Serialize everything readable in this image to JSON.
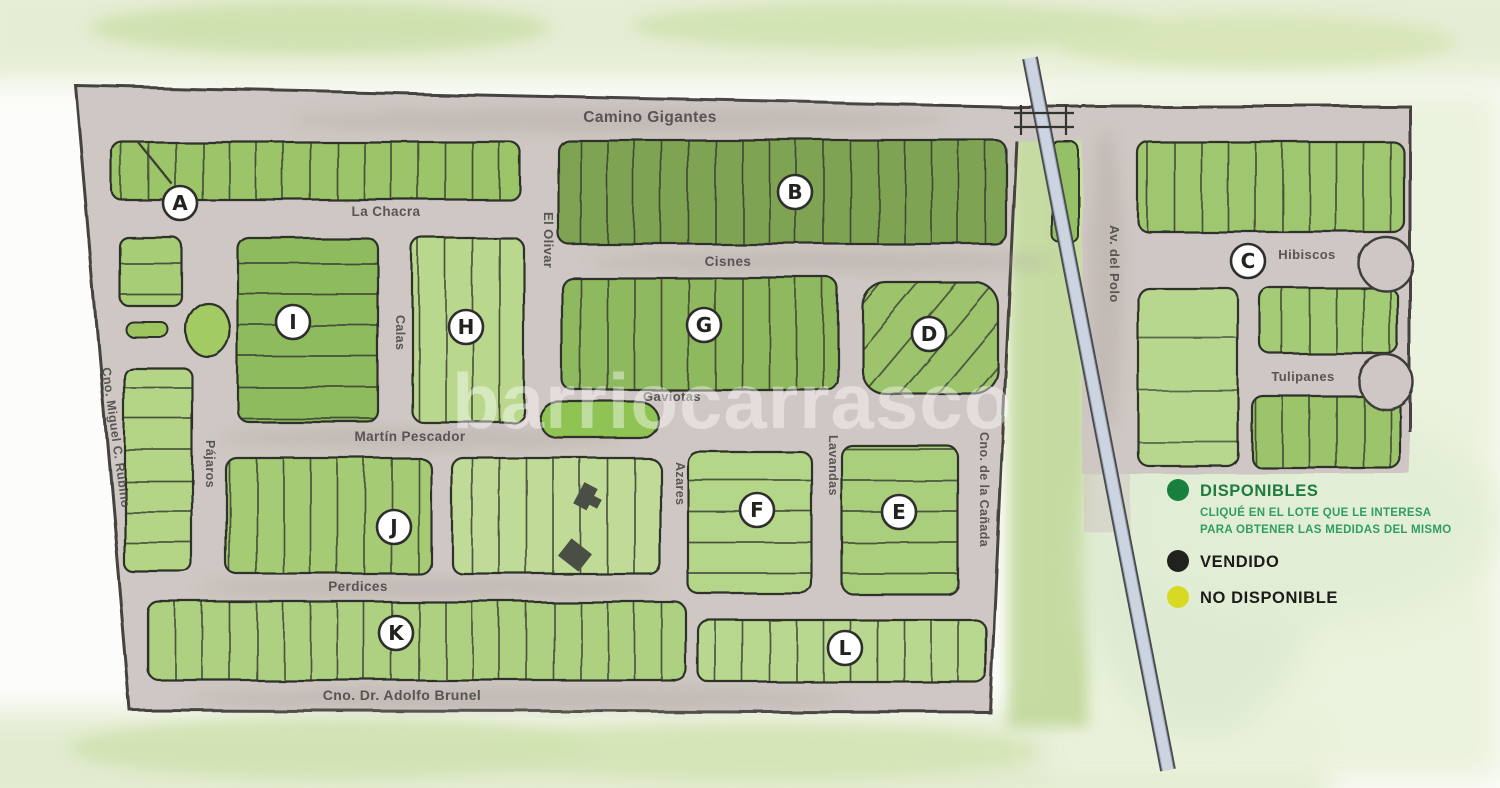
{
  "watermark": "barriocarrasco",
  "streets": {
    "camino_gigantes": "Camino Gigantes",
    "la_chacra": "La Chacra",
    "el_olivar": "El Olivar",
    "cisnes": "Cisnes",
    "gaviotas": "Gaviotas",
    "martin_pescador": "Martín Pescador",
    "perdices": "Perdices",
    "adolfo_brunel": "Cno. Dr. Adolfo Brunel",
    "miguel_rubino": "Cno. Miguel C. Rubino",
    "pajaros": "Pájaros",
    "calas": "Calas",
    "azares": "Azares",
    "lavandas": "Lavandas",
    "canada": "Cno. de la Cañada",
    "av_del_polo": "Av. del Polo",
    "hibiscos": "Hibiscos",
    "tulipanes": "Tulipanes"
  },
  "sections": {
    "a": "A",
    "b": "B",
    "c": "C",
    "d": "D",
    "e": "E",
    "f": "F",
    "g": "G",
    "h": "H",
    "i": "I",
    "j": "J",
    "k": "K",
    "l": "L"
  },
  "legend": {
    "available": {
      "label": "DISPONIBLES",
      "note_line1": "CLIQUÉ EN EL LOTE QUE LE INTERESA",
      "note_line2": "PARA OBTENER LAS MEDIDAS DEL MISMO",
      "color": "#17803f",
      "note_color": "#2f9e5e"
    },
    "sold": {
      "label": "VENDIDO",
      "color": "#21221e"
    },
    "unavailable": {
      "label": "NO DISPONIBLE",
      "color": "#d8d922"
    }
  }
}
